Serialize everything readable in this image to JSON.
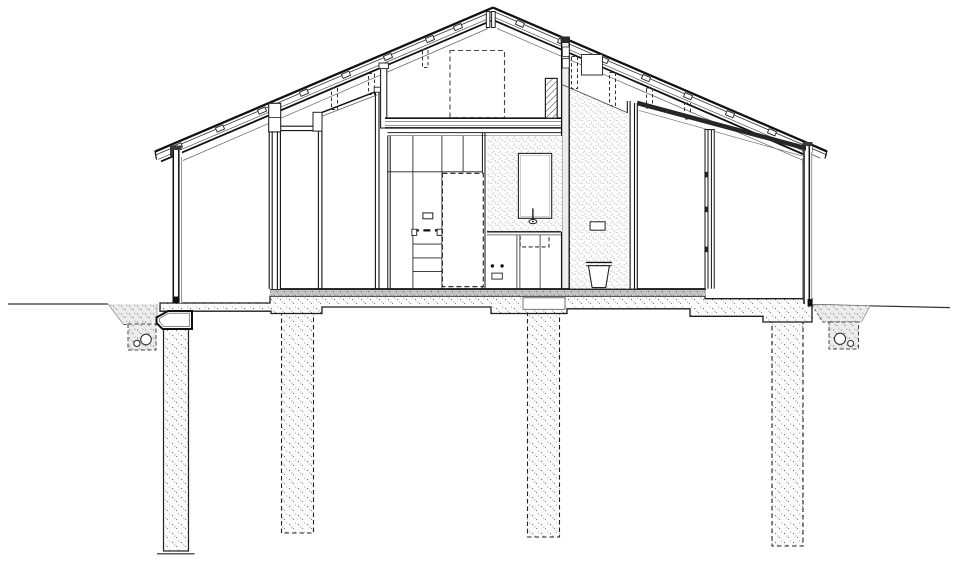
{
  "document": {
    "kind": "architectural-section-drawing",
    "view": "transverse cross-section of a gabled single-storey house on piles",
    "visible_text": [],
    "background_color": "#ffffff",
    "ink_color": "#1d1d1d",
    "stipple_color": "#6e6e6e",
    "screed_color": "#c3c3c3"
  },
  "drawing": {
    "roof": {
      "type": "gable",
      "apex": {
        "x": 493,
        "y": 8
      },
      "left_eave": {
        "x": 155,
        "y": 152
      },
      "right_eave": {
        "x": 827,
        "y": 151
      },
      "layers": 4,
      "battens_left": 8,
      "battens_right": 7,
      "dashed_hanger_posts": 7,
      "ridge_posts": 2,
      "vent_box_on_right_slope": true
    },
    "loft": {
      "floor_span_x": [
        385,
        561
      ],
      "floor_y": [
        118,
        128
      ],
      "dashed_skylight_shaft": {
        "x": 450,
        "y": 50,
        "w": 55,
        "h": 67
      },
      "hatched_chimney_cut": {
        "x": 545,
        "y": 78,
        "w": 12,
        "h": 40
      }
    },
    "walls": {
      "left_exterior": {
        "x": 173,
        "top": 150,
        "bottom": 303
      },
      "right_exterior": {
        "x": 804,
        "top": 146,
        "bottom": 304
      },
      "interior_partitions_x": [
        269,
        318,
        375,
        388,
        561,
        627
      ],
      "sloped_top_panel": true,
      "glazed_porch_post": {
        "x": 705,
        "hinge_marks": 3
      },
      "porch_roof_beam": {
        "from": [
          637,
          101
        ],
        "to": [
          806,
          148
        ]
      }
    },
    "kitchen": {
      "cabinet_block_x": [
        388,
        487
      ],
      "upper_cabinet_line_y": 172,
      "refrigerator_dashed_outline": {
        "x": 442,
        "y": 173,
        "w": 41,
        "h": 113
      },
      "shelf_lines_y": [
        244,
        258,
        271
      ],
      "counter_y": 232,
      "handle_count": 2,
      "knob_count": 2
    },
    "bathroom_core": {
      "stippled_wall_x": [
        487,
        562
      ],
      "mirror": {
        "x": 518,
        "y": 153,
        "w": 33,
        "h": 65
      },
      "faucet": true,
      "sink_dashed": true,
      "second_stippled_wall_x": [
        570,
        628
      ],
      "wall_outlet": {
        "x": 590,
        "y": 222
      },
      "toilet": {
        "x": 586,
        "y": 262
      },
      "door_handle": true
    },
    "ground": {
      "grade_line_y_left": 304,
      "grade_line_y_right": 306,
      "left_trench": {
        "x": [
          108,
          157
        ],
        "dashed_pipe_box": true,
        "pipes": 2
      },
      "right_trench": {
        "x": [
          812,
          870
        ],
        "dashed_pipe_box": true,
        "pipes": 2
      },
      "edge_beam_detail": {
        "x": [
          157,
          192
        ],
        "y": [
          311,
          329
        ]
      }
    },
    "foundation": {
      "slab_span_x": [
        160,
        812
      ],
      "screed_band": {
        "x": [
          270,
          706
        ],
        "y": [
          289,
          296
        ]
      },
      "recessed_box": {
        "x": 523,
        "y": 298,
        "w": 42,
        "h": 11
      },
      "piles": [
        {
          "id": 1,
          "outline": "solid",
          "x": [
            163,
            189
          ],
          "top": 328,
          "bottom": 551,
          "base_line": true
        },
        {
          "id": 2,
          "outline": "dashed",
          "x": [
            281,
            314
          ],
          "top": 312,
          "bottom": 533
        },
        {
          "id": 3,
          "outline": "dashed",
          "x": [
            527,
            560
          ],
          "top": 312,
          "bottom": 537
        },
        {
          "id": 4,
          "outline": "dashed",
          "x": [
            772,
            803
          ],
          "top": 321,
          "bottom": 546
        }
      ]
    }
  }
}
